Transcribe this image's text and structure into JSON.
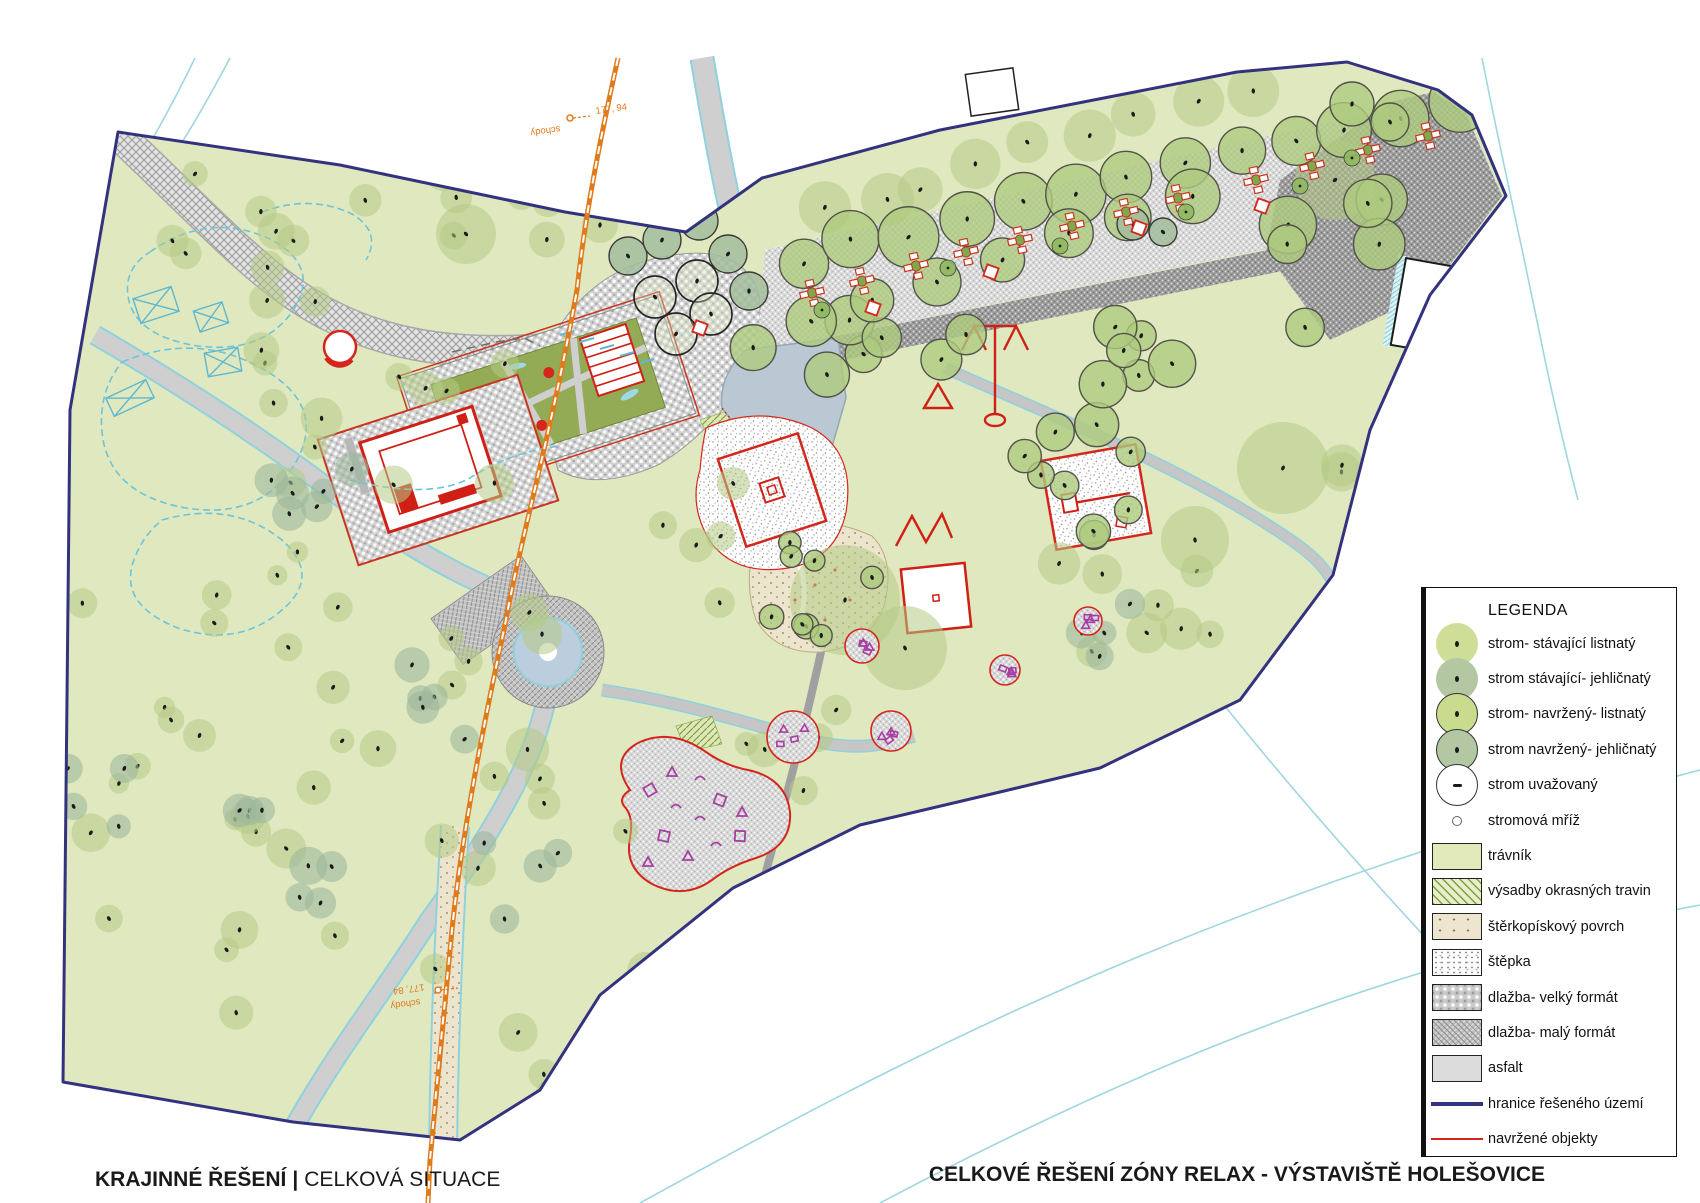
{
  "titles": {
    "bottom_left_primary": "KRAJINNÉ ŘEŠENÍ",
    "bottom_left_separator": "|",
    "bottom_left_secondary": "CELKOVÁ SITUACE",
    "bottom_right": "CELKOVÉ ŘEŠENÍ ZÓNY RELAX - VÝSTAVIŠTĚ HOLEŠOVICE"
  },
  "legend": {
    "title": "LEGENDA",
    "items": [
      {
        "label": "strom- stávající listnatý",
        "symbol": "tree-existing-deciduous"
      },
      {
        "label": "strom stávající- jehličnatý",
        "symbol": "tree-existing-coniferous"
      },
      {
        "label": "strom- navržený- listnatý",
        "symbol": "tree-proposed-deciduous"
      },
      {
        "label": "strom navržený- jehličnatý",
        "symbol": "tree-proposed-coniferous"
      },
      {
        "label": "strom uvažovaný",
        "symbol": "tree-considered"
      },
      {
        "label": "stromová mříž",
        "symbol": "tree-grate"
      },
      {
        "label": "trávník",
        "symbol": "lawn"
      },
      {
        "label": "výsadby okrasných travin",
        "symbol": "ornamental-grasses"
      },
      {
        "label": "štěrkopískový povrch",
        "symbol": "gravel-sand"
      },
      {
        "label": "štěpka",
        "symbol": "wood-chips"
      },
      {
        "label": "dlažba- velký formát",
        "symbol": "paving-large"
      },
      {
        "label": "dlažba- malý formát",
        "symbol": "paving-small"
      },
      {
        "label": "asfalt",
        "symbol": "asphalt"
      },
      {
        "label": "hranice řešeného území",
        "symbol": "boundary-line"
      },
      {
        "label": "navržené objekty",
        "symbol": "proposed-objects-line"
      }
    ]
  },
  "map_labels": [
    {
      "text": "177, 94",
      "x": 596,
      "y": 114,
      "rot": -8
    },
    {
      "text": "schody",
      "x": 560,
      "y": 126,
      "rot": 172
    },
    {
      "text": "177, 84",
      "x": 424,
      "y": 984,
      "rot": 172
    },
    {
      "text": "schody",
      "x": 420,
      "y": 999,
      "rot": 172
    }
  ],
  "colors": {
    "grass": "#e0e8c0",
    "boundary": "#32327e",
    "red": "#d5261b",
    "orange": "#e07a1a",
    "cyan": "#8ed2de",
    "purple": "#a73fa3",
    "water": "#b9c8d3",
    "road": "#cfcfcf",
    "tree_deciduous": "#b5ca85",
    "tree_coniferous": "#9db89c"
  },
  "trees": {
    "rows": [
      {
        "type": "ed",
        "n": 9,
        "x1": 825,
        "y1": 212,
        "x2": 1245,
        "y2": 92,
        "r": 24,
        "jit": 10,
        "seed": 301
      },
      {
        "type": "pd",
        "n": 13,
        "x1": 800,
        "y1": 258,
        "x2": 1455,
        "y2": 103,
        "r": 27,
        "jit": 6,
        "seed": 302
      },
      {
        "type": "pd",
        "n": 8,
        "x1": 748,
        "y1": 344,
        "x2": 1190,
        "y2": 197,
        "r": 24,
        "jit": 6,
        "seed": 303
      }
    ],
    "clusters": [
      {
        "type": "ed",
        "n": 10,
        "x1": 150,
        "y1": 140,
        "x2": 430,
        "y2": 330,
        "r1": 10,
        "r2": 20,
        "seed": 11
      },
      {
        "type": "ed",
        "n": 12,
        "x1": 260,
        "y1": 340,
        "x2": 560,
        "y2": 555,
        "r1": 11,
        "r2": 22,
        "seed": 22
      },
      {
        "type": "ec",
        "n": 6,
        "x1": 270,
        "y1": 440,
        "x2": 355,
        "y2": 530,
        "r1": 12,
        "r2": 18,
        "seed": 33
      },
      {
        "type": "ed",
        "n": 10,
        "x1": 80,
        "y1": 520,
        "x2": 340,
        "y2": 720,
        "r1": 10,
        "r2": 18,
        "seed": 44
      },
      {
        "type": "ed",
        "n": 16,
        "x1": 80,
        "y1": 720,
        "x2": 430,
        "y2": 1055,
        "r1": 10,
        "r2": 20,
        "seed": 55
      },
      {
        "type": "ec",
        "n": 7,
        "x1": 235,
        "y1": 810,
        "x2": 335,
        "y2": 905,
        "r1": 13,
        "r2": 20,
        "seed": 66
      },
      {
        "type": "ed",
        "n": 12,
        "x1": 440,
        "y1": 600,
        "x2": 650,
        "y2": 895,
        "r1": 12,
        "r2": 22,
        "seed": 77
      },
      {
        "type": "ec",
        "n": 5,
        "x1": 385,
        "y1": 650,
        "x2": 480,
        "y2": 780,
        "r1": 12,
        "r2": 18,
        "seed": 88
      },
      {
        "type": "ed",
        "n": 14,
        "x1": 430,
        "y1": 950,
        "x2": 900,
        "y2": 1130,
        "r1": 11,
        "r2": 22,
        "seed": 99
      },
      {
        "type": "ec",
        "n": 4,
        "x1": 60,
        "y1": 730,
        "x2": 160,
        "y2": 830,
        "r1": 11,
        "r2": 16,
        "seed": 101
      },
      {
        "type": "ed",
        "n": 10,
        "x1": 840,
        "y1": 1000,
        "x2": 1020,
        "y2": 1135,
        "r1": 11,
        "r2": 18,
        "seed": 111
      },
      {
        "type": "pd",
        "n": 7,
        "x1": 1090,
        "y1": 300,
        "x2": 1260,
        "y2": 430,
        "r1": 15,
        "r2": 24,
        "seed": 121
      },
      {
        "type": "pd",
        "n": 6,
        "x1": 1280,
        "y1": 190,
        "x2": 1410,
        "y2": 330,
        "r1": 18,
        "r2": 30,
        "seed": 131
      },
      {
        "type": "pd",
        "n": 8,
        "x1": 1020,
        "y1": 430,
        "x2": 1160,
        "y2": 560,
        "r1": 13,
        "r2": 19,
        "seed": 141
      },
      {
        "type": "pd",
        "n": 8,
        "x1": 755,
        "y1": 525,
        "x2": 880,
        "y2": 645,
        "r1": 10,
        "r2": 15,
        "seed": 151
      },
      {
        "type": "ed",
        "n": 8,
        "x1": 1050,
        "y1": 545,
        "x2": 1230,
        "y2": 665,
        "r1": 13,
        "r2": 22,
        "seed": 161
      },
      {
        "type": "ec",
        "n": 4,
        "x1": 1060,
        "y1": 600,
        "x2": 1130,
        "y2": 660,
        "r1": 12,
        "r2": 16,
        "seed": 171
      },
      {
        "type": "pd",
        "n": 6,
        "x1": 820,
        "y1": 310,
        "x2": 1010,
        "y2": 400,
        "r1": 18,
        "r2": 26,
        "seed": 191
      },
      {
        "type": "ed",
        "n": 5,
        "x1": 1280,
        "y1": 420,
        "x2": 1420,
        "y2": 540,
        "r1": 16,
        "r2": 26,
        "seed": 201
      },
      {
        "type": "ed",
        "n": 6,
        "x1": 430,
        "y1": 140,
        "x2": 560,
        "y2": 300,
        "r1": 12,
        "r2": 20,
        "seed": 211
      },
      {
        "type": "ed",
        "n": 5,
        "x1": 650,
        "y1": 480,
        "x2": 770,
        "y2": 620,
        "r1": 12,
        "r2": 18,
        "seed": 221
      },
      {
        "type": "ed",
        "n": 5,
        "x1": 740,
        "y1": 690,
        "x2": 840,
        "y2": 800,
        "r1": 12,
        "r2": 18,
        "seed": 231
      },
      {
        "type": "ed",
        "n": 6,
        "x1": 620,
        "y1": 920,
        "x2": 790,
        "y2": 1060,
        "r1": 12,
        "r2": 20,
        "seed": 241
      },
      {
        "type": "ec",
        "n": 4,
        "x1": 480,
        "y1": 840,
        "x2": 570,
        "y2": 930,
        "r1": 12,
        "r2": 17,
        "seed": 251
      }
    ],
    "singles": [
      {
        "type": "ed",
        "x": 466,
        "y": 234,
        "r": 30
      },
      {
        "type": "ed",
        "x": 845,
        "y": 600,
        "r": 55
      },
      {
        "type": "ed",
        "x": 905,
        "y": 648,
        "r": 42
      },
      {
        "type": "ed",
        "x": 1283,
        "y": 468,
        "r": 46
      },
      {
        "type": "ed",
        "x": 1195,
        "y": 540,
        "r": 34
      },
      {
        "type": "ed",
        "x": 1335,
        "y": 180,
        "r": 40
      },
      {
        "type": "ed",
        "x": 600,
        "y": 225,
        "r": 18
      },
      {
        "type": "pc",
        "x": 628,
        "y": 256,
        "r": 19
      },
      {
        "type": "pc",
        "x": 662,
        "y": 240,
        "r": 19
      },
      {
        "type": "pc",
        "x": 699,
        "y": 221,
        "r": 19
      },
      {
        "type": "pc",
        "x": 728,
        "y": 254,
        "r": 19
      },
      {
        "type": "pc",
        "x": 749,
        "y": 291,
        "r": 19
      },
      {
        "type": "bk",
        "x": 655,
        "y": 297,
        "r": 21
      },
      {
        "type": "bk",
        "x": 697,
        "y": 281,
        "r": 21
      },
      {
        "type": "bk",
        "x": 711,
        "y": 314,
        "r": 21
      },
      {
        "type": "bk",
        "x": 676,
        "y": 334,
        "r": 21
      },
      {
        "type": "pc",
        "x": 1133,
        "y": 224,
        "r": 16
      },
      {
        "type": "pc",
        "x": 1163,
        "y": 232,
        "r": 14
      },
      {
        "type": "pd",
        "x": 1352,
        "y": 104,
        "r": 22
      },
      {
        "type": "pd",
        "x": 1390,
        "y": 122,
        "r": 19
      }
    ]
  },
  "furniture": {
    "picnic_tables": [
      {
        "x": 812,
        "y": 293
      },
      {
        "x": 862,
        "y": 281
      },
      {
        "x": 916,
        "y": 266
      },
      {
        "x": 966,
        "y": 252
      },
      {
        "x": 1020,
        "y": 240
      },
      {
        "x": 1072,
        "y": 226
      },
      {
        "x": 1126,
        "y": 212
      },
      {
        "x": 1178,
        "y": 198
      },
      {
        "x": 1256,
        "y": 180
      },
      {
        "x": 1312,
        "y": 166
      },
      {
        "x": 1368,
        "y": 150
      },
      {
        "x": 1428,
        "y": 136
      }
    ],
    "red_squares": [
      {
        "x": 873,
        "y": 308
      },
      {
        "x": 991,
        "y": 272
      },
      {
        "x": 1139,
        "y": 228
      },
      {
        "x": 1262,
        "y": 206
      },
      {
        "x": 700,
        "y": 328
      }
    ],
    "grate_trees": [
      {
        "x": 822,
        "y": 310
      },
      {
        "x": 948,
        "y": 268
      },
      {
        "x": 1060,
        "y": 246
      },
      {
        "x": 1186,
        "y": 212
      },
      {
        "x": 1300,
        "y": 186
      },
      {
        "x": 1352,
        "y": 158
      }
    ],
    "playground_circles": [
      {
        "x": 793,
        "y": 737,
        "r": 26
      },
      {
        "x": 891,
        "y": 731,
        "r": 20
      },
      {
        "x": 862,
        "y": 646,
        "r": 17
      },
      {
        "x": 1088,
        "y": 621,
        "r": 14
      },
      {
        "x": 1005,
        "y": 670,
        "r": 15
      }
    ]
  }
}
